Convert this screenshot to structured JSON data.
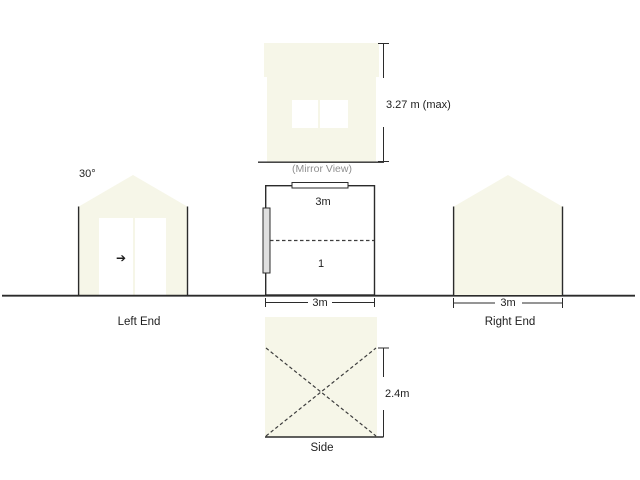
{
  "colors": {
    "background": "#FFFFFF",
    "shape_fill": "#F6F6E8",
    "outline": "#2B2B2B",
    "muted_text": "#8F8F8F",
    "plan_door_fill": "#E0E0E0"
  },
  "mirror_view": {
    "caption": "(Mirror View)",
    "height_dimension": "3.27 m (max)"
  },
  "left_end": {
    "label": "Left End",
    "roof_angle": "30°",
    "door_arrow": "➔"
  },
  "floor_plan": {
    "depth_dimension": "3m",
    "bay_number": "1",
    "width_dimension": "3m"
  },
  "right_end": {
    "label": "Right End",
    "width_dimension": "3m"
  },
  "side_view": {
    "label": "Side",
    "height_dimension": "2.4m"
  }
}
